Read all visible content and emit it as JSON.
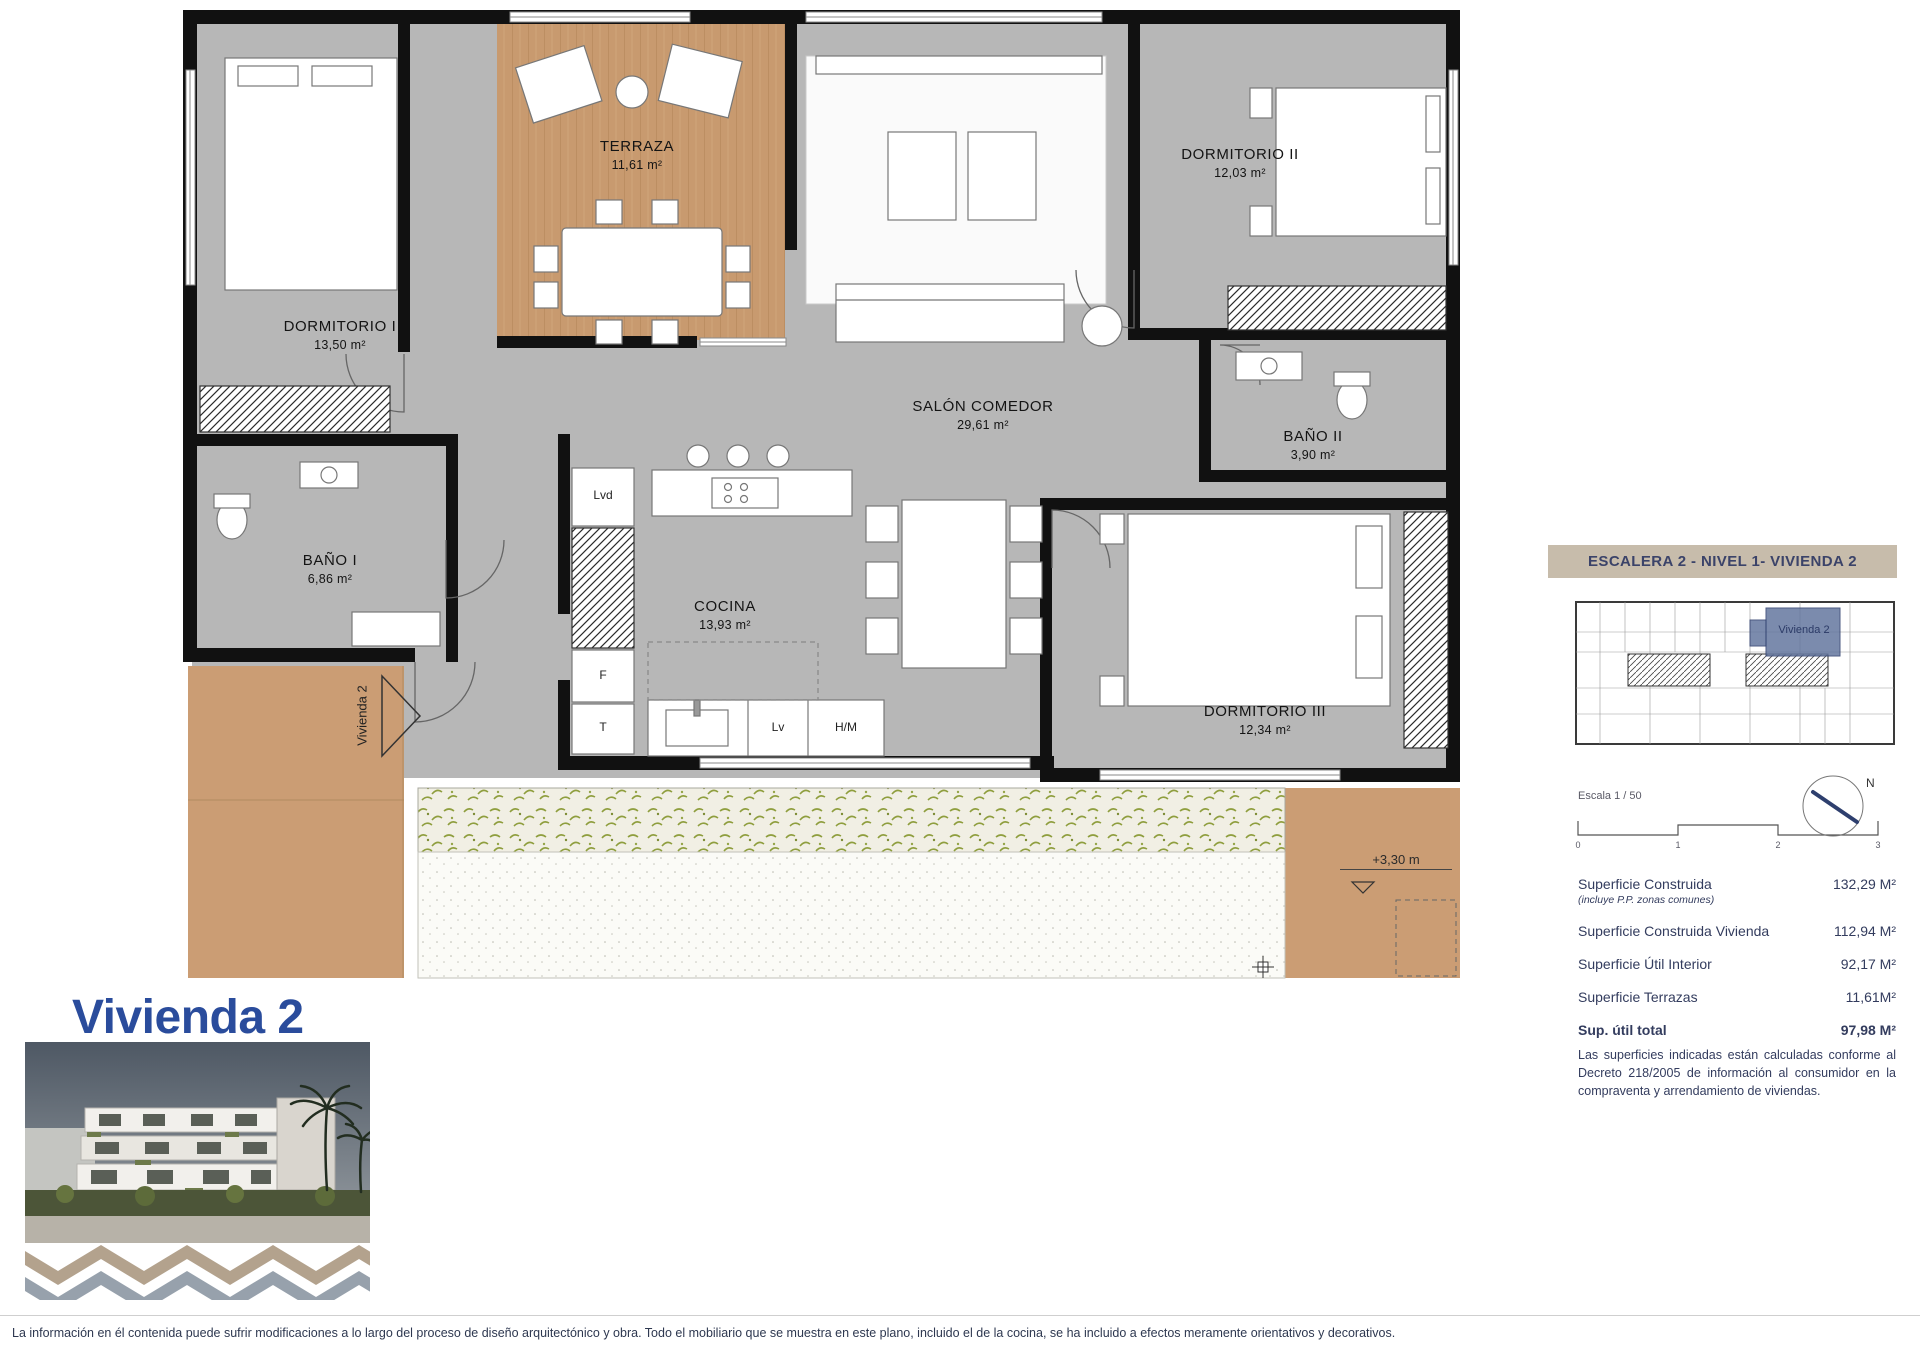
{
  "floor_plan": {
    "rooms": [
      {
        "name": "TERRAZA",
        "area": "11,61 m²"
      },
      {
        "name": "DORMITORIO I",
        "area": "13,50 m²"
      },
      {
        "name": "DORMITORIO II",
        "area": "12,03 m²"
      },
      {
        "name": "SALÓN COMEDOR",
        "area": "29,61 m²"
      },
      {
        "name": "BAÑO I",
        "area": "6,86 m²"
      },
      {
        "name": "BAÑO II",
        "area": "3,90 m²"
      },
      {
        "name": "COCINA",
        "area": "13,93 m²"
      },
      {
        "name": "DORMITORIO III",
        "area": "12,34 m²"
      }
    ],
    "appliances": {
      "lvd": "Lvd",
      "f": "F",
      "t": "T",
      "lv": "Lv",
      "hm": "H/M"
    },
    "entrance_label": "Vivienda 2",
    "level_marker": "+3,30 m"
  },
  "info_panel": {
    "header": "ESCALERA 2 - NIVEL 1- VIVIENDA 2",
    "key_plan_unit_label": "Vivienda 2",
    "scale_label": "Escala 1 / 50",
    "scale_ticks": [
      "0",
      "1",
      "2",
      "3"
    ],
    "compass_label": "N",
    "surfaces": [
      {
        "label": "Superficie Construida",
        "sublabel": "(incluye P.P. zonas comunes)",
        "value": "132,29 M²"
      },
      {
        "label": "Superficie Construida Vivienda",
        "value": "112,94 M²"
      },
      {
        "label": "Superficie Útil Interior",
        "value": "92,17 M²"
      },
      {
        "label": "Superficie Terrazas",
        "value": "11,61M²"
      },
      {
        "label": "Sup. útil total",
        "value": "97,98 M²"
      }
    ],
    "legal_note": "Las superficies indicadas están calculadas conforme al Decreto 218/2005 de información al consumidor en la compraventa y arrendamiento de viviendas."
  },
  "title_block": {
    "title": "Vivienda 2"
  },
  "page": {
    "footer_disclaimer": "La información en él contenida puede sufrir modificaciones a lo largo del proceso de diseño arquitectónico y obra. Todo el mobiliario que se muestra en este plano, incluido el de la cocina, se ha incluido a efectos meramente orientativos y decorativos."
  },
  "colors": {
    "accent_blue": "#2a4c9c",
    "navy_text": "#333c5e",
    "header_beige": "#c7bcab",
    "floor_gray": "#b7b7b7",
    "terrace_tan": "#cb9d74",
    "wood": "#c89a6f",
    "keyplan_highlight": "#64779f"
  }
}
